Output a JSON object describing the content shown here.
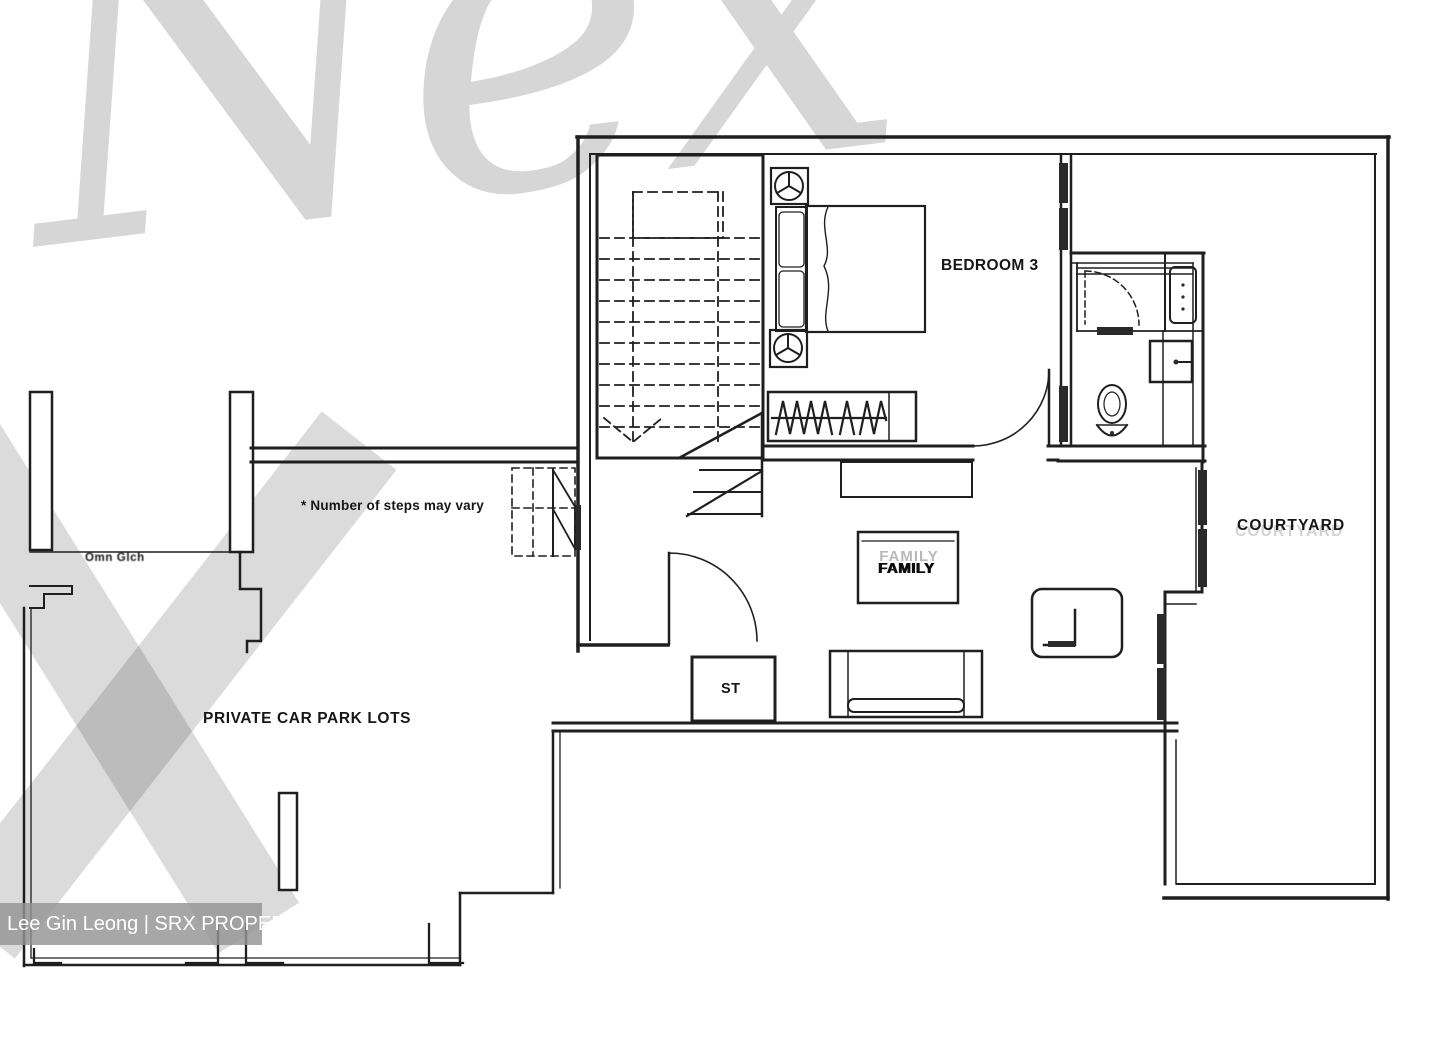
{
  "rooms": {
    "bedroom3": "BEDROOM 3",
    "courtyard": "COURTYARD",
    "family": "FAMILY",
    "storage": "ST",
    "carpark": "PRIVATE CAR PARK LOTS"
  },
  "notes": {
    "steps": "* Number of steps may vary",
    "wall_annotation": "Omn Glch"
  },
  "watermarks": {
    "brand_ghost": "Nex",
    "credit": "Lee Gin Leong | SRX PROPERTY"
  },
  "colors": {
    "line": "#1f1f1f",
    "paper": "#ffffff",
    "watermark_gray": "rgba(0,0,0,0.16)",
    "credit_bg": "rgba(148,148,148,0.82)",
    "credit_text": "#ffffff"
  }
}
